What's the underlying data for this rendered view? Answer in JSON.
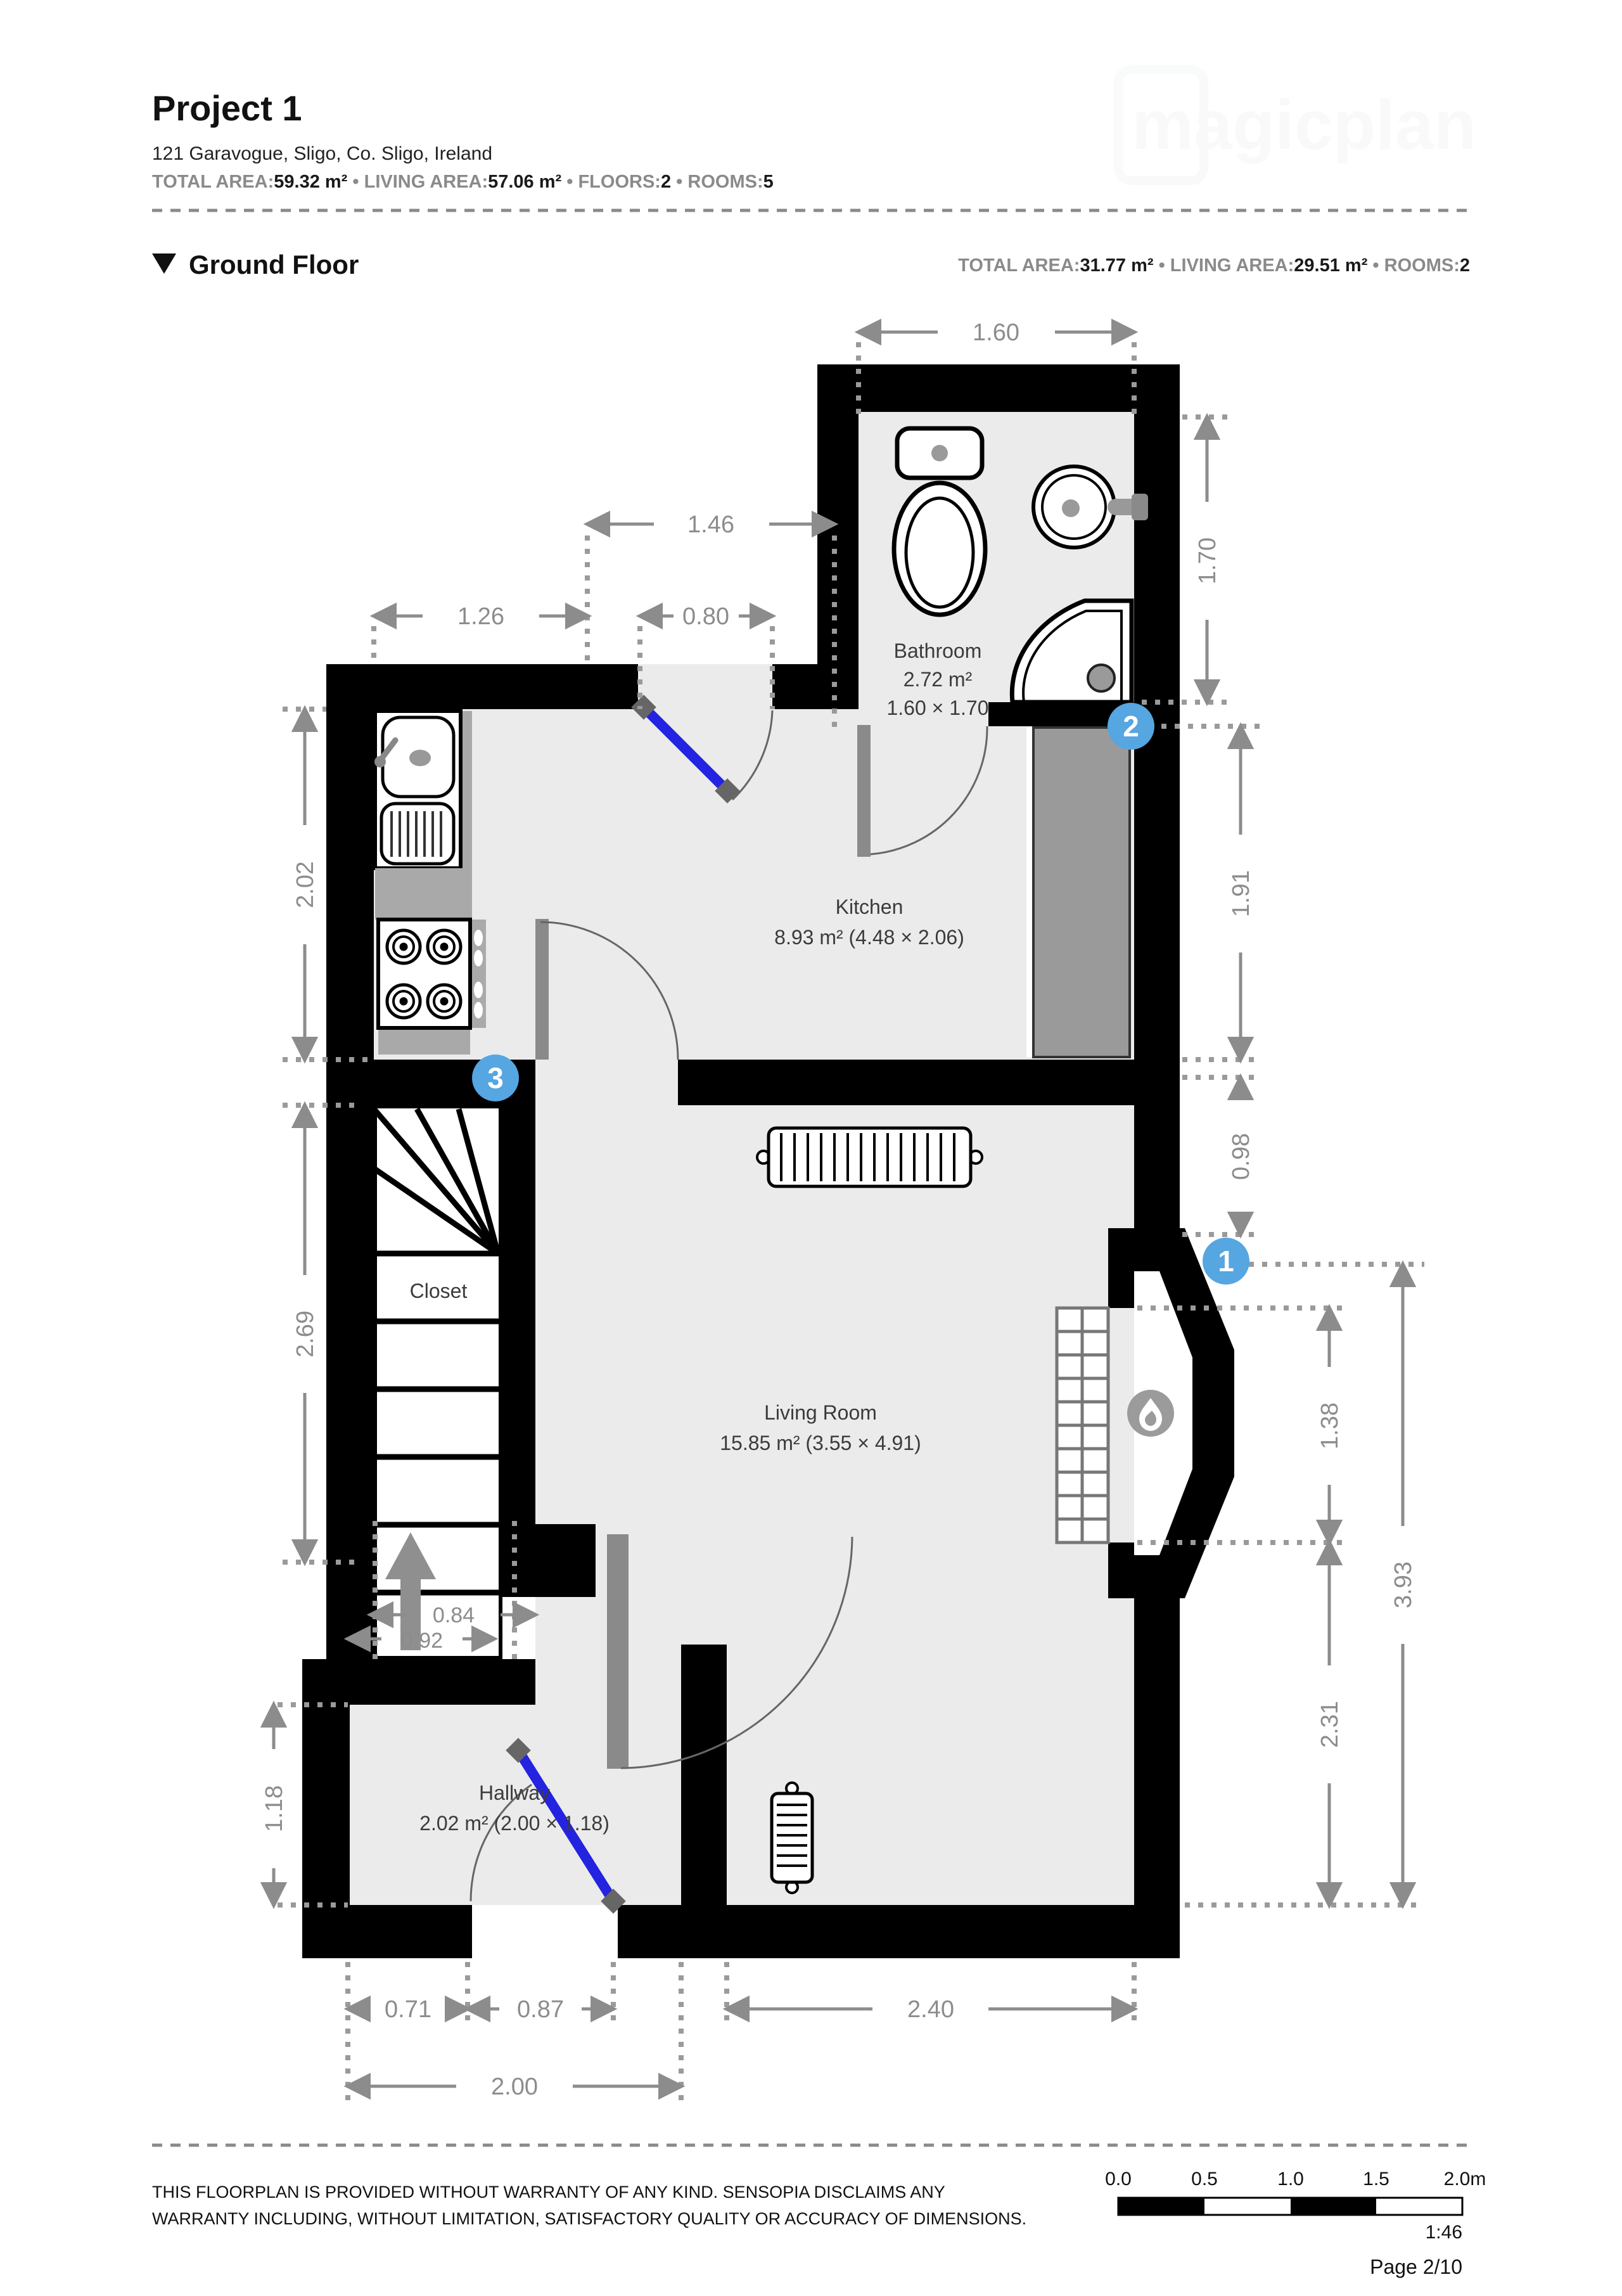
{
  "header": {
    "title": "Project 1",
    "address": "121 Garavogue,  Sligo, Co. Sligo, Ireland",
    "watermark": "magicplan",
    "stats": {
      "total_area_label": "TOTAL AREA:",
      "total_area": "59.32 m²",
      "living_area_label": "LIVING AREA:",
      "living_area": "57.06 m²",
      "floors_label": "FLOORS:",
      "floors": "2",
      "rooms_label": "ROOMS:",
      "rooms": "5",
      "sep": " • "
    }
  },
  "floor_section": {
    "name": "Ground Floor",
    "stats": {
      "total_area_label": "TOTAL AREA:",
      "total_area": "31.77 m²",
      "living_area_label": "LIVING AREA:",
      "living_area": "29.51 m²",
      "rooms_label": "ROOMS:",
      "rooms": "2",
      "sep": " • "
    }
  },
  "rooms": {
    "bathroom": {
      "name": "Bathroom",
      "area": "2.72 m²",
      "dims": "1.60 × 1.70"
    },
    "kitchen": {
      "name": "Kitchen",
      "detail": "8.93 m² (4.48 × 2.06)"
    },
    "living": {
      "name": "Living Room",
      "detail": "15.85 m² (3.55 × 4.91)"
    },
    "hallway": {
      "name": "Hallway",
      "detail": "2.02 m² (2.00 × 1.18)"
    },
    "closet": {
      "name": "Closet"
    }
  },
  "dimensions": {
    "w160": "1.60",
    "w146": "1.46",
    "w126": "1.26",
    "w080": "0.80",
    "h202": "2.02",
    "h269": "2.69",
    "h118": "1.18",
    "h170": "1.70",
    "h191": "1.91",
    "h098": "0.98",
    "h138": "1.38",
    "h231": "2.31",
    "h393": "3.93",
    "w240": "2.40",
    "w071": "0.71",
    "w087": "0.87",
    "w200": "2.00",
    "w084": "0.84",
    "w092": "0.92"
  },
  "markers": {
    "m1": "1",
    "m2": "2",
    "m3": "3"
  },
  "colors": {
    "marker_blue": "#55a6e1",
    "door_blue": "#2323e0",
    "wall": "#000000",
    "floor": "#ebebeb",
    "dim_gray": "#8c8c8c"
  },
  "footer": {
    "disclaimer_line1": "THIS FLOORPLAN IS PROVIDED WITHOUT WARRANTY OF ANY KIND. SENSOPIA DISCLAIMS ANY",
    "disclaimer_line2": "WARRANTY INCLUDING, WITHOUT LIMITATION, SATISFACTORY QUALITY OR ACCURACY OF DIMENSIONS.",
    "scale_ticks": [
      "0.0",
      "0.5",
      "1.0",
      "1.5",
      "2.0m"
    ],
    "scale_ratio": "1:46",
    "page": "Page 2/10"
  }
}
